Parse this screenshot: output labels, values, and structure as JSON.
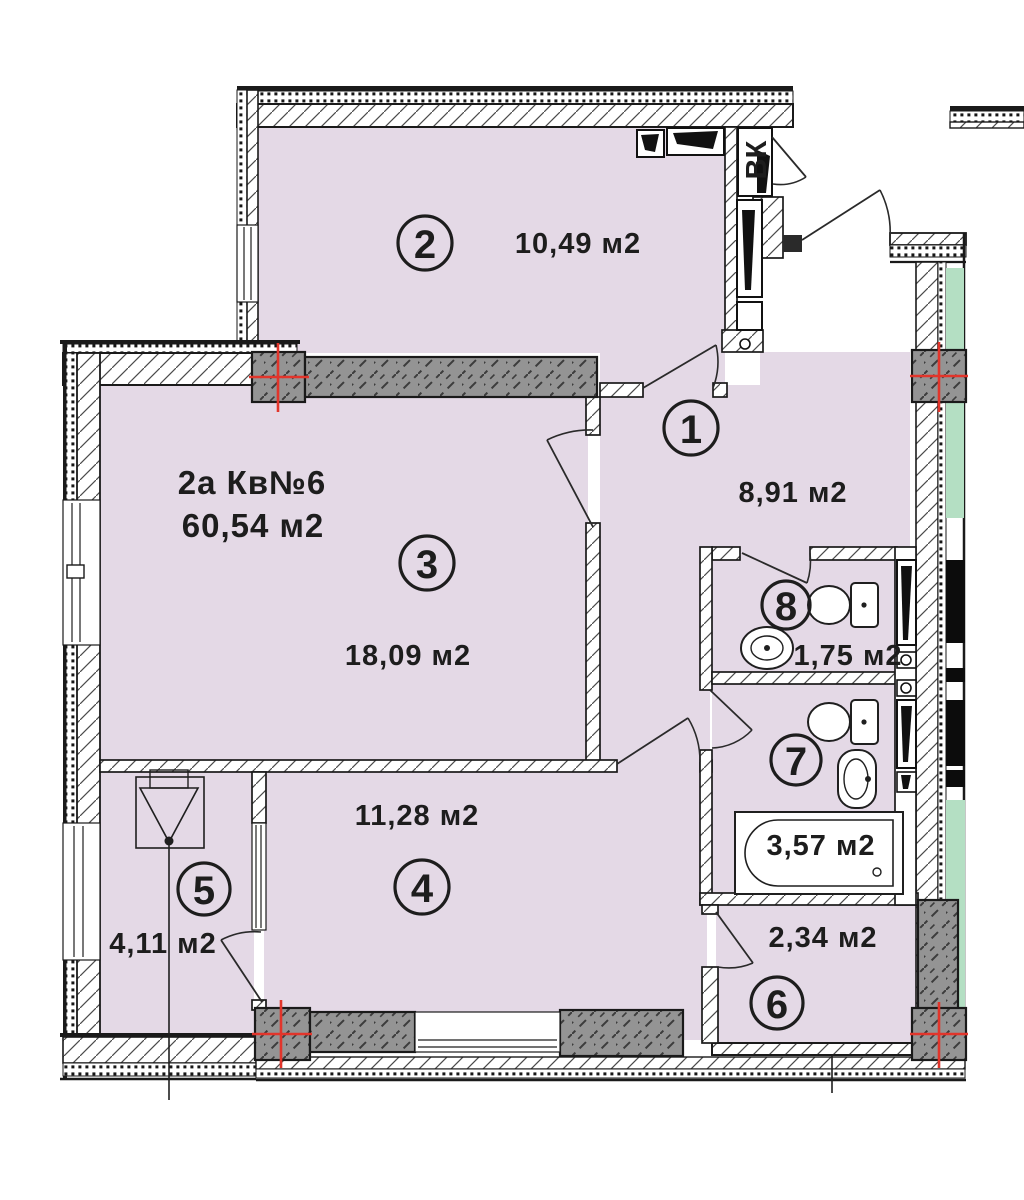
{
  "plan": {
    "apartment_title_line1": "2а Кв№6",
    "apartment_title_line2": "60,54 м2",
    "shaft_label": "ВК",
    "colors": {
      "room_fill": "#e4d9e6",
      "balcony_green": "#b4dfc3",
      "column_gray": "#949494",
      "marker_red": "#e2352b",
      "shaft_label_blue": "#1d1ce0"
    },
    "rooms": [
      {
        "number": "1",
        "area": "8,91 м2"
      },
      {
        "number": "2",
        "area": "10,49 м2"
      },
      {
        "number": "3",
        "area": "18,09 м2"
      },
      {
        "number": "4",
        "area": "11,28 м2"
      },
      {
        "number": "5",
        "area": "4,11 м2"
      },
      {
        "number": "6",
        "area": "2,34 м2"
      },
      {
        "number": "7",
        "area": "3,57 м2"
      },
      {
        "number": "8",
        "area": "1,75 м2"
      }
    ]
  }
}
